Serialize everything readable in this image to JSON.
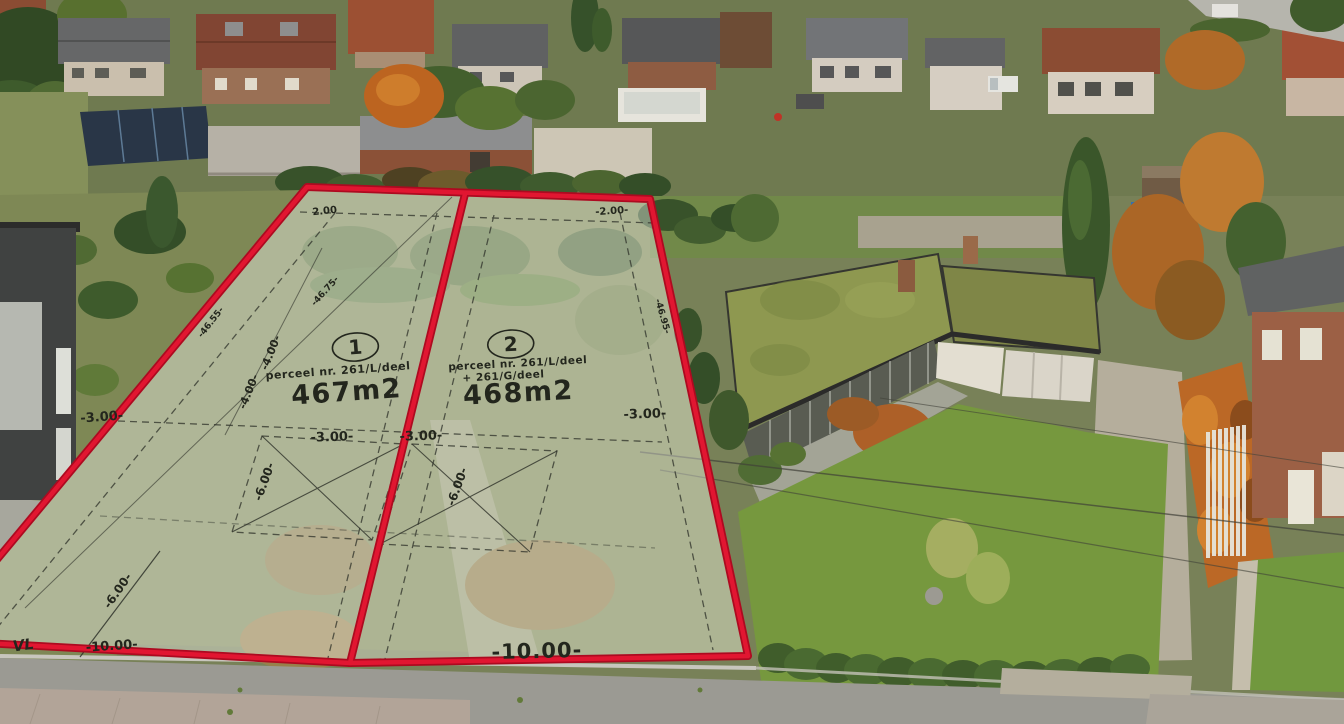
{
  "scene": {
    "description": "Aerial drone photo of a residential street; two building plots for sale outlined in red with survey overlay",
    "colors": {
      "plot_outline": "#d8112e",
      "plot_fill": "#f3f5f0",
      "annotation_ink": "#23261d",
      "lawn_green": "#74993f",
      "autumn_foliage": "#b5712c",
      "moss_roof": "#8d9952",
      "street_grey": "#9b9c97"
    }
  },
  "plots": [
    {
      "number": "1",
      "parcel_line1": "perceel nr. 261/L/deel",
      "area": "467m2"
    },
    {
      "number": "2",
      "parcel_line1": "perceel nr. 261/L/deel",
      "parcel_line2": "+ 261/G/deel",
      "area": "468m2"
    }
  ],
  "dimensions": {
    "top_left": "2.00",
    "top_right": "-2.00-",
    "left_strip": "-3.00-",
    "side_a": "-4.00-",
    "side_b": "-4.00-",
    "depth_left": "-46.55-",
    "depth_middle": "-46.75-",
    "depth_right": "-46.95-",
    "plot1_front": "-3.00-",
    "plot2_front": "-3.00-",
    "right_strip": "-3.00-",
    "plot1_side": "-6.00-",
    "plot2_side": "-6.00-",
    "front_left": "-6.00-",
    "frontage_left": "-10.00-",
    "frontage_main": "-10.00-",
    "corner_mark": "VL"
  }
}
